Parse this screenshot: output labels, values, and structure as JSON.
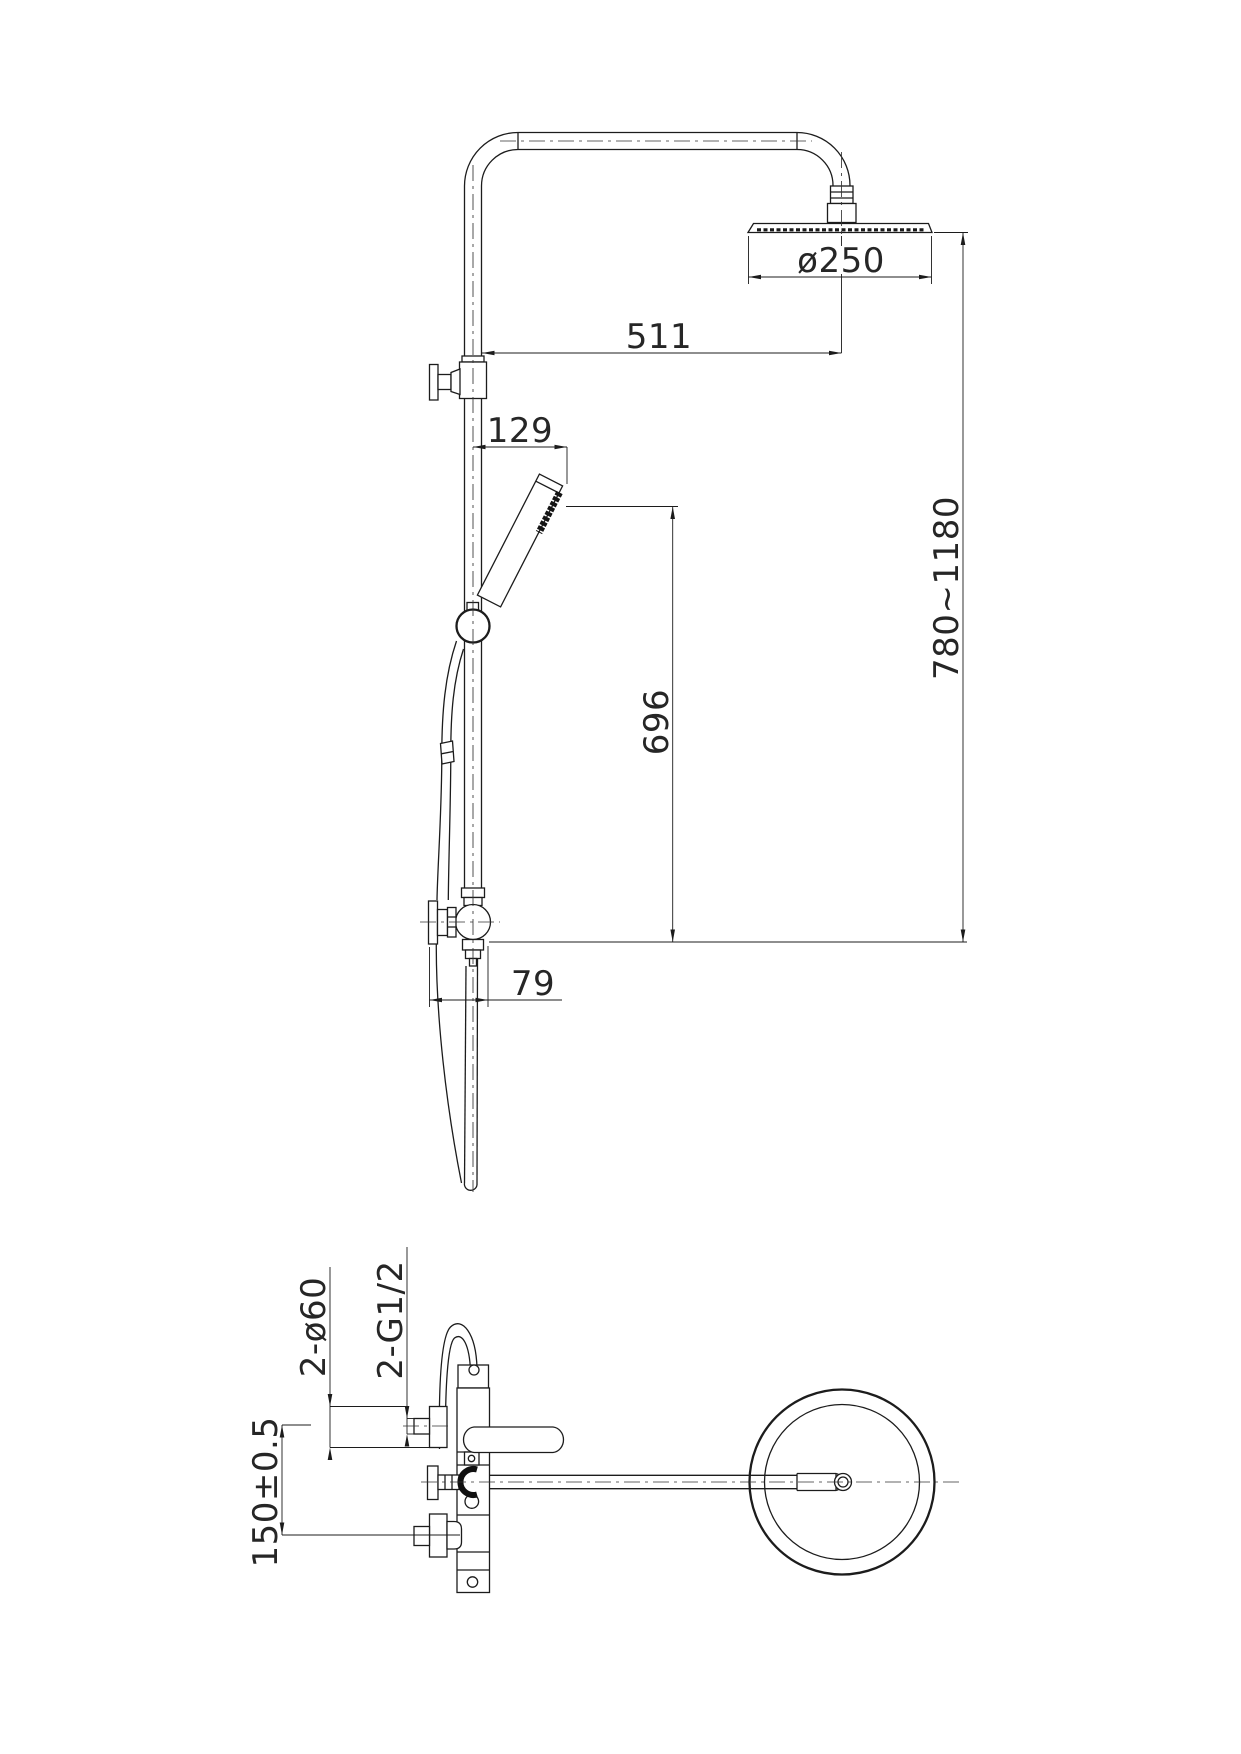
{
  "colors": {
    "line": "#1c1c1c",
    "background": "#ffffff",
    "text": "#262626"
  },
  "dims": {
    "d250": "ø250",
    "d511": "511",
    "d129": "129",
    "d696": "696",
    "d79": "79",
    "d780": "780~1180",
    "d60": "2-ø60",
    "dg12": "2-G1/2",
    "d150": "150±0.5"
  }
}
